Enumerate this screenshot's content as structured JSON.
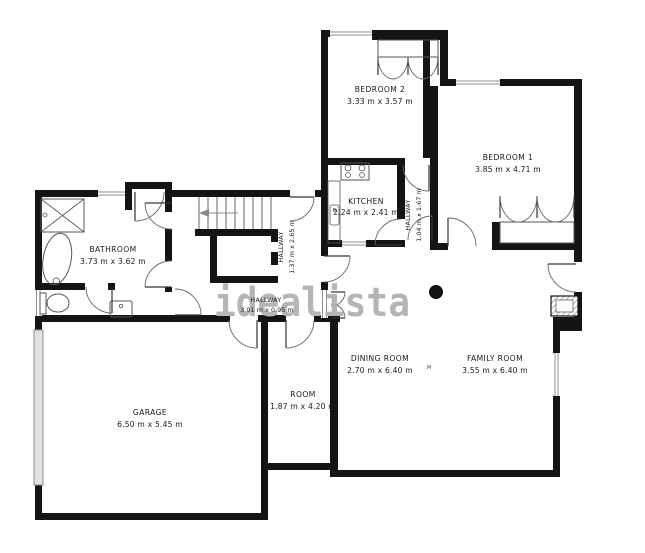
{
  "watermark": "idealista",
  "marker": "M",
  "rooms": {
    "bedroom2": {
      "name": "BEDROOM 2",
      "dims": "3.33 m x 3.57 m"
    },
    "bedroom1": {
      "name": "BEDROOM 1",
      "dims": "3.85 m x 4.71 m"
    },
    "kitchen": {
      "name": "KITCHEN",
      "dims": "2.24 m x 2.41 m"
    },
    "hallway_small": {
      "name": "HALLWAY",
      "dims": "1.04 m x 1.67 m"
    },
    "hallway_vertical": {
      "name": "HALLWAY",
      "dims": "1.37 m x 2.65 m"
    },
    "hallway_horizontal": {
      "name": "HALLWAY",
      "dims": "3.01 m x 0.95 m"
    },
    "bathroom": {
      "name": "BATHROOM",
      "dims": "3.73 m x 3.62 m"
    },
    "dining_room": {
      "name": "DINING ROOM",
      "dims": "2.70 m x 6.40 m"
    },
    "family_room": {
      "name": "FAMILY ROOM",
      "dims": "3.55 m x 6.40 m"
    },
    "garage": {
      "name": "GARAGE",
      "dims": "6.50 m x 5.45 m"
    },
    "room": {
      "name": "ROOM",
      "dims": "1.87 m x 4.20 m"
    }
  },
  "colors": {
    "wall": "#141414",
    "label": "#1a1a1a",
    "watermark": "#b5b5b5",
    "window": "#8f8f8f",
    "garage_door_fill": "#e2e2e2"
  }
}
